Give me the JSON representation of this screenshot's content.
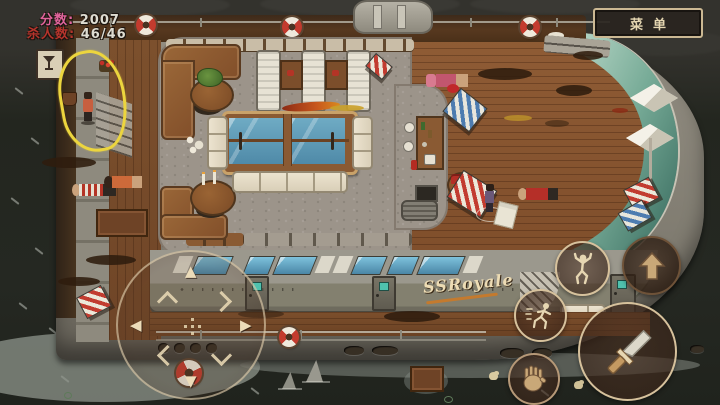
{
  "hud": {
    "score_label": "分数:",
    "score_value": "2007",
    "kills_label": "杀人数:",
    "kills_value": "46/46"
  },
  "menu": {
    "label": "菜单"
  },
  "ship": {
    "name": "SSRoyale"
  },
  "controls": {
    "dpad": {
      "up": "▲",
      "down": "▼",
      "left": "◀",
      "right": "▶"
    },
    "action_buttons": [
      {
        "id": "dance",
        "icon": "dancer-icon"
      },
      {
        "id": "climb",
        "icon": "up-arrow-icon"
      },
      {
        "id": "run",
        "icon": "runner-icon"
      },
      {
        "id": "attack",
        "icon": "knife-icon"
      },
      {
        "id": "interact",
        "icon": "hand-icon"
      }
    ]
  },
  "colors": {
    "score_pink": "#e0649c",
    "kills_red": "#b5342c",
    "value_light": "#dedcd2",
    "highlight_yellow": "#ecd53e",
    "button_outline": "#d6c19c",
    "teal_bow": "#5d907f",
    "deck_wood": "#8a5632",
    "water": "#23261f"
  }
}
